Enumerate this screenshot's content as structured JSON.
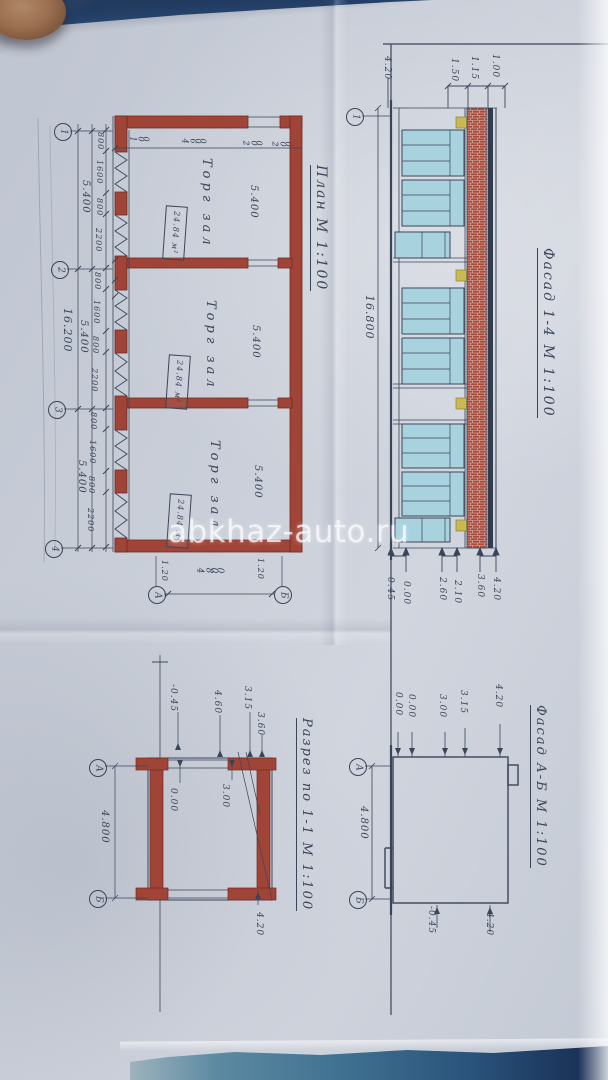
{
  "watermark": "abkhaz-auto.ru",
  "plan": {
    "title": "План М 1:100",
    "rooms": [
      {
        "label": "Торг зал",
        "area": "24.84 м²",
        "width_dim": "5.400"
      },
      {
        "label": "Торг зал",
        "area": "24.84 м²",
        "width_dim": "5.400"
      },
      {
        "label": "Торг зал",
        "area": "24.84 м²",
        "width_dim": "5.400"
      }
    ],
    "axis_row_markers": [
      "1",
      "2",
      "3",
      "4"
    ],
    "axis_col_markers": [
      "А",
      "Б"
    ],
    "spacing_dims": [
      "5.400",
      "5.400",
      "5.400"
    ],
    "total_dim": "16.200",
    "depth_dim": "4.800",
    "edge_dims": [
      "1.20",
      "1.20"
    ],
    "window_dims": [
      "800",
      "1600",
      "800",
      "2200",
      "800",
      "1600",
      "800",
      "2200",
      "800",
      "1600",
      "800",
      "2200"
    ],
    "front_dims": [
      "1.00",
      "4.600",
      "2.00",
      "2.00"
    ]
  },
  "fasad14": {
    "title": "Фасад 1-4 М 1:100",
    "axis_marker": "1",
    "length_dim": "16.800",
    "top_level": "4.20",
    "width_dims": [
      "1.50",
      "1.15",
      "1.00"
    ],
    "bottom_levels": [
      "0.45",
      "0.00",
      "2.60",
      "2.10",
      "3.60",
      "4.20"
    ]
  },
  "razrez": {
    "title": "Разрез по 1-1 М 1:100",
    "top_levels": [
      "-0.45",
      "4.60",
      "3.15",
      "3.60"
    ],
    "floor_level": "0.00",
    "ceiling_level": "3.00",
    "bottom_level": "4.20",
    "axis_markers": [
      "А",
      "Б"
    ],
    "depth_dim": "4.800"
  },
  "fasadAB": {
    "title": "Фасад А-Б М 1:100",
    "axis_markers": [
      "А",
      "Б"
    ],
    "depth_dim": "4.800",
    "ground_levels": [
      "0.00",
      "0.00"
    ],
    "height_levels": [
      "3.00",
      "3.15",
      "4.20"
    ],
    "bottom_levels": [
      "-0.45",
      "4.20"
    ]
  },
  "colors": {
    "paper": "#c8cdd7",
    "ink": "#3b4559",
    "wall_red": "#a04438",
    "glass": "#a8d2de",
    "accent_yellow": "#c9b952",
    "photo_blue_top": "#2c4d79",
    "photo_cloth_bottom": "#3f7090"
  }
}
